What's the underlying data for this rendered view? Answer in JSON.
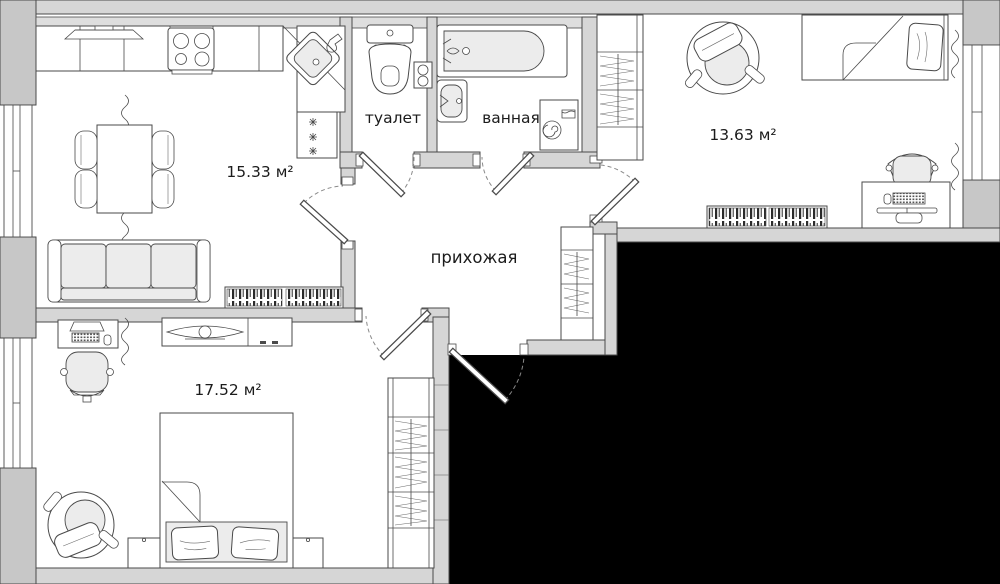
{
  "rooms": [
    {
      "id": "kitchen-living-room",
      "label": "15.33 м²"
    },
    {
      "id": "toilet",
      "label": "туалет"
    },
    {
      "id": "bathroom",
      "label": "ванная"
    },
    {
      "id": "bedroom",
      "label": "13.63 м²"
    },
    {
      "id": "hallway",
      "label": "прихожая"
    },
    {
      "id": "bedroom-2",
      "label": "17.52 м²"
    }
  ],
  "colors": {
    "background": "#ffffff",
    "wall_fill": "#d6d6d6",
    "wall_stroke": "#4a4a4a",
    "furniture_fill": "#ffffff",
    "cushion_fill": "#ececec",
    "hidden_area": "#000000"
  }
}
